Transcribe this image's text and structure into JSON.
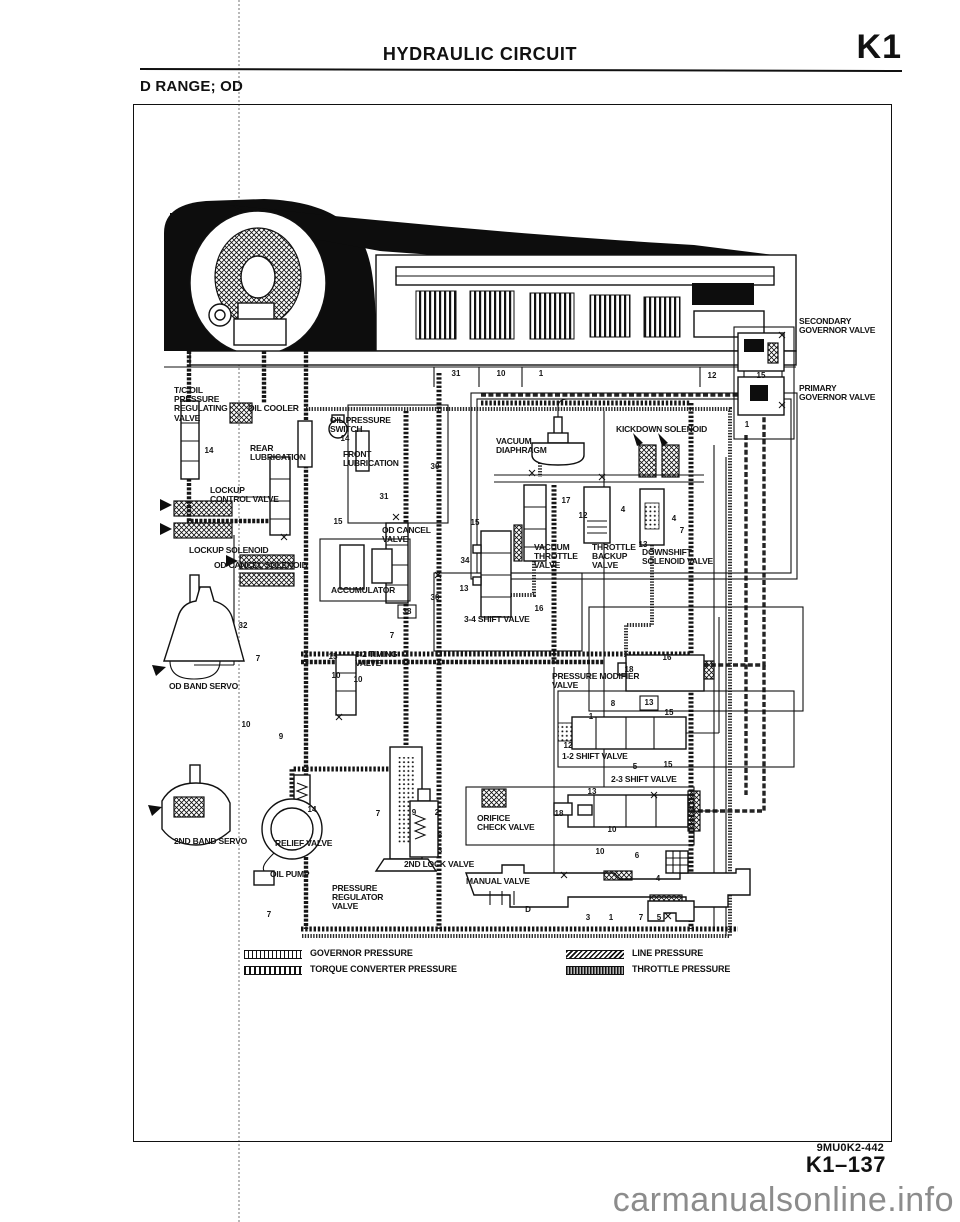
{
  "page": {
    "title": "HYDRAULIC CIRCUIT",
    "section_code": "K1",
    "subtitle": "D RANGE; OD",
    "doc_code": "9MU0K2-442",
    "page_code": "K1–137",
    "watermark": "carmanualsonline.info"
  },
  "legend": {
    "items": [
      {
        "id": "governor-pressure",
        "label": "GOVERNOR PRESSURE"
      },
      {
        "id": "torque-converter-pressure",
        "label": "TORQUE CONVERTER PRESSURE"
      },
      {
        "id": "line-pressure",
        "label": "LINE PRESSURE"
      },
      {
        "id": "throttle-pressure",
        "label": "THROTTLE PRESSURE"
      }
    ]
  },
  "diagram": {
    "labels": [
      {
        "text": "T/C OIL\nPRESSURE\nREGULATING\nVALVE",
        "x": 40,
        "y": 281
      },
      {
        "text": "OIL COOLER",
        "x": 114,
        "y": 299
      },
      {
        "text": "OIL PRESSURE\nSWITCH",
        "x": 196,
        "y": 311
      },
      {
        "text": "REAR\nLUBRICATION",
        "x": 116,
        "y": 339
      },
      {
        "text": "FRONT\nLUBRICATION",
        "x": 209,
        "y": 345
      },
      {
        "text": "VACUUM\nDIAPHRAGM",
        "x": 362,
        "y": 332
      },
      {
        "text": "KICKDOWN SOLENOID",
        "x": 482,
        "y": 320
      },
      {
        "text": "LOCKUP\nCONTROL VALVE",
        "x": 76,
        "y": 381
      },
      {
        "text": "OD CANCEL\nVALVE",
        "x": 248,
        "y": 421
      },
      {
        "text": "LOCKUP SOLENOID",
        "x": 55,
        "y": 441
      },
      {
        "text": "OD CANCEL SOLENOID",
        "x": 80,
        "y": 456
      },
      {
        "text": "ACCUMULATOR",
        "x": 197,
        "y": 481
      },
      {
        "text": "VACUUM\nTHROTTLE\nVALVE",
        "x": 400,
        "y": 438
      },
      {
        "text": "THROTTLE\nBACKUP\nVALVE",
        "x": 458,
        "y": 438
      },
      {
        "text": "DOWNSHIFT\nSOLENOID VALVE",
        "x": 508,
        "y": 443
      },
      {
        "text": "3-2 TIMING\nVALVE",
        "x": 221,
        "y": 545
      },
      {
        "text": "OD BAND SERVO",
        "x": 35,
        "y": 577
      },
      {
        "text": "3-4 SHIFT VALVE",
        "x": 330,
        "y": 510
      },
      {
        "text": "PRESSURE MODIFIER\nVALVE",
        "x": 418,
        "y": 567
      },
      {
        "text": "1-2 SHIFT VALVE",
        "x": 428,
        "y": 647
      },
      {
        "text": "2-3 SHIFT VALVE",
        "x": 477,
        "y": 670
      },
      {
        "text": "ORIFICE\nCHECK VALVE",
        "x": 343,
        "y": 709
      },
      {
        "text": "2ND BAND SERVO",
        "x": 40,
        "y": 732
      },
      {
        "text": "RELIEF VALVE",
        "x": 141,
        "y": 734
      },
      {
        "text": "OIL PUMP",
        "x": 136,
        "y": 765
      },
      {
        "text": "PRESSURE\nREGULATOR\nVALVE",
        "x": 198,
        "y": 779
      },
      {
        "text": "2ND LOCK VALVE",
        "x": 270,
        "y": 755
      },
      {
        "text": "MANUAL VALVE",
        "x": 332,
        "y": 772
      },
      {
        "text": "SECONDARY\nGOVERNOR VALVE",
        "x": 665,
        "y": 212
      },
      {
        "text": "PRIMARY\nGOVERNOR VALVE",
        "x": 665,
        "y": 279
      }
    ],
    "numbers": [
      {
        "text": "31",
        "x": 322,
        "y": 269
      },
      {
        "text": "10",
        "x": 367,
        "y": 269
      },
      {
        "text": "1",
        "x": 407,
        "y": 269
      },
      {
        "text": "12",
        "x": 578,
        "y": 271
      },
      {
        "text": "15",
        "x": 627,
        "y": 271
      },
      {
        "text": "1",
        "x": 613,
        "y": 320
      },
      {
        "text": "14",
        "x": 75,
        "y": 346
      },
      {
        "text": "14",
        "x": 211,
        "y": 334
      },
      {
        "text": "30",
        "x": 301,
        "y": 362
      },
      {
        "text": "17",
        "x": 432,
        "y": 396
      },
      {
        "text": "12",
        "x": 449,
        "y": 411
      },
      {
        "text": "4",
        "x": 489,
        "y": 405
      },
      {
        "text": "4",
        "x": 540,
        "y": 414
      },
      {
        "text": "7",
        "x": 548,
        "y": 426
      },
      {
        "text": "13",
        "x": 509,
        "y": 440
      },
      {
        "text": "15",
        "x": 341,
        "y": 418
      },
      {
        "text": "15",
        "x": 204,
        "y": 417
      },
      {
        "text": "31",
        "x": 250,
        "y": 392
      },
      {
        "text": "34",
        "x": 331,
        "y": 456
      },
      {
        "text": "13",
        "x": 330,
        "y": 484
      },
      {
        "text": "30",
        "x": 301,
        "y": 493
      },
      {
        "text": "32",
        "x": 109,
        "y": 521
      },
      {
        "text": "38",
        "x": 273,
        "y": 507
      },
      {
        "text": "7",
        "x": 258,
        "y": 531
      },
      {
        "text": "15",
        "x": 199,
        "y": 552
      },
      {
        "text": "10",
        "x": 202,
        "y": 571
      },
      {
        "text": "10",
        "x": 224,
        "y": 575
      },
      {
        "text": "7",
        "x": 124,
        "y": 554
      },
      {
        "text": "10",
        "x": 112,
        "y": 620
      },
      {
        "text": "9",
        "x": 147,
        "y": 632
      },
      {
        "text": "16",
        "x": 405,
        "y": 504
      },
      {
        "text": "16",
        "x": 533,
        "y": 553
      },
      {
        "text": "18",
        "x": 495,
        "y": 565
      },
      {
        "text": "8",
        "x": 479,
        "y": 599
      },
      {
        "text": "13",
        "x": 515,
        "y": 598
      },
      {
        "text": "15",
        "x": 535,
        "y": 608
      },
      {
        "text": "1",
        "x": 457,
        "y": 612
      },
      {
        "text": "12",
        "x": 434,
        "y": 641
      },
      {
        "text": "5",
        "x": 501,
        "y": 662
      },
      {
        "text": "15",
        "x": 534,
        "y": 660
      },
      {
        "text": "13",
        "x": 458,
        "y": 687
      },
      {
        "text": "18",
        "x": 425,
        "y": 709
      },
      {
        "text": "10",
        "x": 478,
        "y": 725
      },
      {
        "text": "10",
        "x": 466,
        "y": 747
      },
      {
        "text": "6",
        "x": 503,
        "y": 751
      },
      {
        "text": "4",
        "x": 524,
        "y": 774
      },
      {
        "text": "9",
        "x": 280,
        "y": 708
      },
      {
        "text": "2",
        "x": 303,
        "y": 708
      },
      {
        "text": "8",
        "x": 306,
        "y": 731
      },
      {
        "text": "3",
        "x": 306,
        "y": 746
      },
      {
        "text": "14",
        "x": 178,
        "y": 705
      },
      {
        "text": "7",
        "x": 244,
        "y": 709
      },
      {
        "text": "7",
        "x": 135,
        "y": 810
      },
      {
        "text": "D",
        "x": 394,
        "y": 805
      },
      {
        "text": "3",
        "x": 454,
        "y": 813
      },
      {
        "text": "1",
        "x": 477,
        "y": 813
      },
      {
        "text": "7",
        "x": 507,
        "y": 813
      },
      {
        "text": "5",
        "x": 525,
        "y": 813
      }
    ]
  },
  "colors": {
    "ink": "#111111",
    "paper": "#ffffff",
    "watermark": "#8c8c8c"
  }
}
